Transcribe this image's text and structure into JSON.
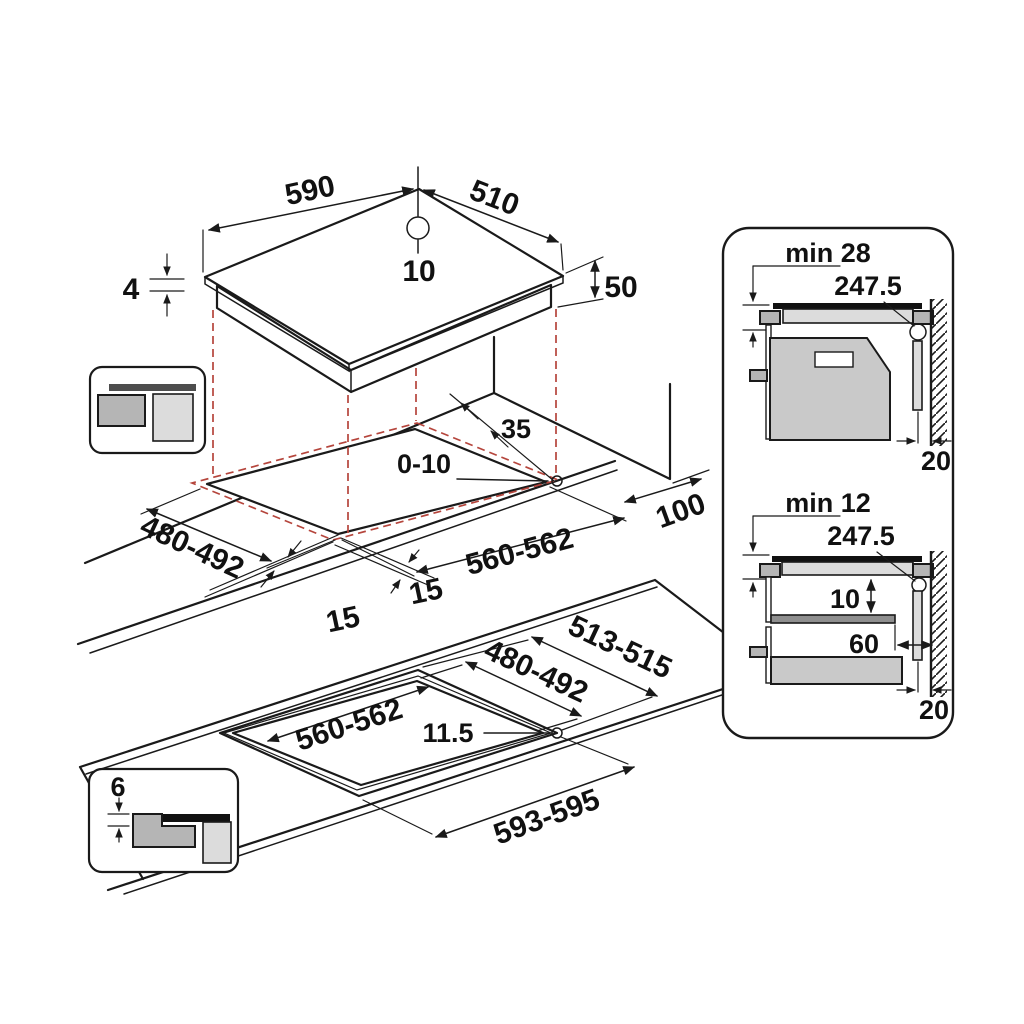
{
  "diagram": {
    "top_view": {
      "width": "590",
      "depth": "510",
      "hole_offset": "10",
      "glass_thickness": "4",
      "body_height": "50"
    },
    "cutout_view": {
      "rear_gap": "35",
      "corner_play": "0-10",
      "depth": "480-492",
      "width": "560-562",
      "margin_left": "15",
      "margin_front": "15",
      "side_gap": "100"
    },
    "flush_view": {
      "outer_depth": "513-515",
      "inner_depth": "480-492",
      "inner_width": "560-562",
      "corner_radius": "11.5",
      "outer_width": "593-595"
    },
    "oven_section": {
      "title": "min 28",
      "duct": "247.5",
      "wall_gap": "20"
    },
    "drawer_section": {
      "title": "min 12",
      "duct": "247.5",
      "clearance": "10",
      "shelf_depth": "60",
      "wall_gap": "20"
    },
    "flush_detail": {
      "recess_depth": "6"
    },
    "colors": {
      "line": "#1a1a1a",
      "projection": "#b5453c",
      "glass": "#111111",
      "gray_mid": "#b5b5b5",
      "gray_light": "#dcdcdc"
    }
  }
}
